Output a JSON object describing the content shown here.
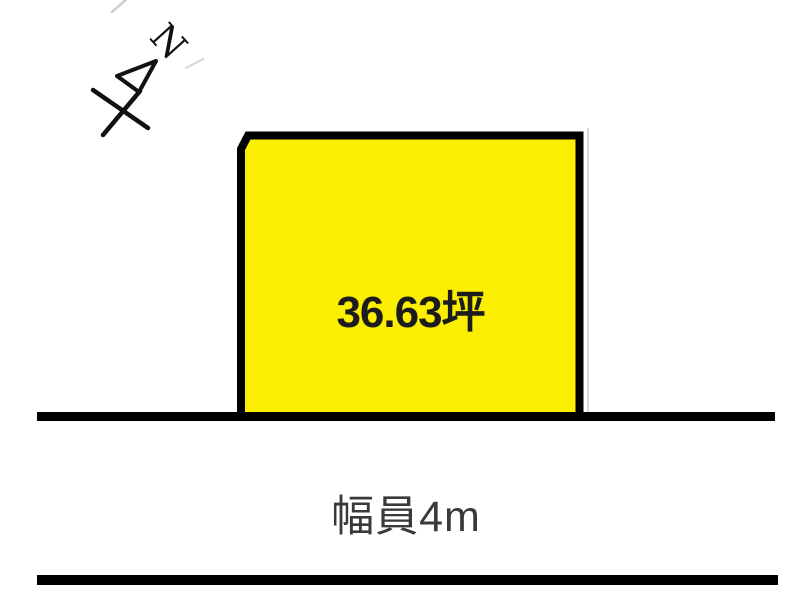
{
  "diagram": {
    "background": "#ffffff"
  },
  "compass": {
    "label": "N",
    "color": "#111111"
  },
  "parcel": {
    "area_label": "36.63坪",
    "fill": "#fcee00",
    "border_color": "#000000",
    "text_color": "#1c1c1c"
  },
  "road": {
    "width_label": "幅員4m",
    "line_color": "#000000",
    "text_color": "#3a3a3a"
  }
}
